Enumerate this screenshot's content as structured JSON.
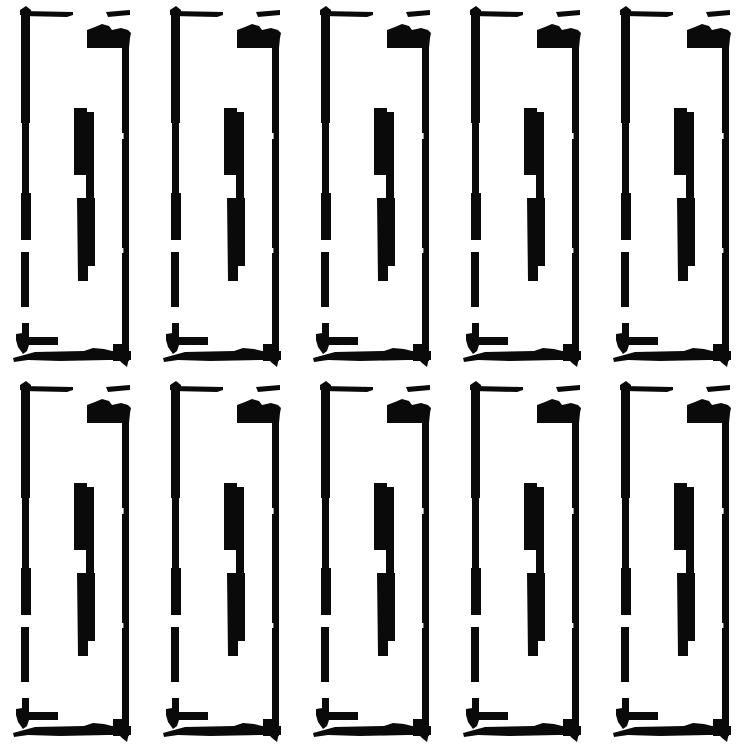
{
  "image": {
    "title": "adhesive-strip-pattern",
    "description": "Black-and-white line-art pattern: ten identical tall rectangular strip outlines (hand-drawn style frame with dashed left edge, solid right edge, top tab blob and a stepped solid inner bar) arranged in a 5-column by 2-row grid on a white background",
    "background_color": "#ffffff",
    "ink_color": "#0a0a0a",
    "canvas": {
      "width": 750,
      "height": 750
    },
    "grid": {
      "columns": 5,
      "rows": 2,
      "tile_count": 10,
      "tile_width": 150,
      "tile_height": 375
    }
  }
}
